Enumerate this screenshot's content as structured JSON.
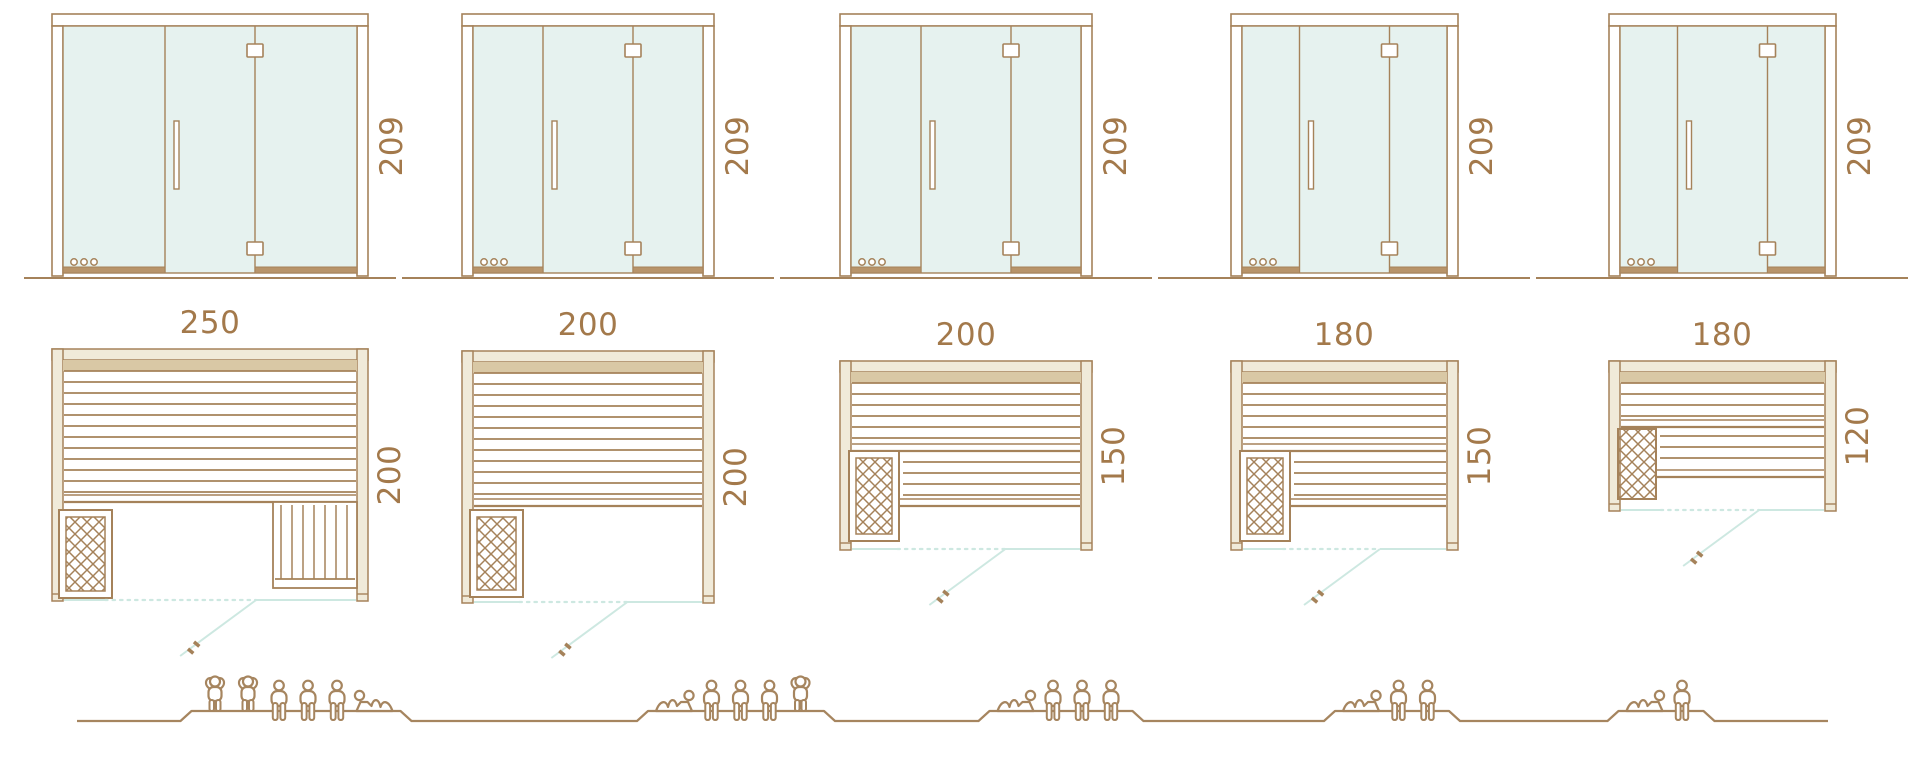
{
  "diagram_title": "sauna-size-comparison",
  "colors": {
    "outline": "#A5825A",
    "label_text": "#A3794B",
    "glass": "#E6F2EF",
    "wall": "#F0EAD9",
    "slat_top": "#D9C8A5",
    "threshold": "#B8946A",
    "swing_line": "#CDE8E1",
    "figure": "#A6855F",
    "background": "#FFFFFF"
  },
  "door": {
    "height_label": "209",
    "features": "glass front with center hinged door, handle, two hinges, three vent holes bottom-left"
  },
  "units": [
    {
      "name": "sauna-250x200",
      "width_label": "250",
      "depth_label": "200",
      "door_height_label": "209",
      "width_cm": 250,
      "depth_cm": 200,
      "plan": "rear bench full width, right side bench, heater front-left, glass front with open door swing",
      "capacity": {
        "standing": 2,
        "sitting": 3,
        "lying": 1
      },
      "figures": [
        "standing",
        "standing",
        "sitting",
        "sitting",
        "sitting",
        "lying"
      ]
    },
    {
      "name": "sauna-200x200",
      "width_label": "200",
      "depth_label": "200",
      "door_height_label": "209",
      "width_cm": 200,
      "depth_cm": 200,
      "plan": "rear bench full width, heater front-left, glass front with open door swing",
      "capacity": {
        "standing": 1,
        "sitting": 3,
        "lying": 1
      },
      "figures": [
        "lying",
        "sitting",
        "sitting",
        "sitting",
        "standing"
      ]
    },
    {
      "name": "sauna-200x150",
      "width_label": "200",
      "depth_label": "150",
      "door_height_label": "209",
      "width_cm": 200,
      "depth_cm": 150,
      "plan": "rear bench full width, lower bench beside heater, heater front-left, glass front with open door swing",
      "capacity": {
        "standing": 0,
        "sitting": 3,
        "lying": 1
      },
      "figures": [
        "lying",
        "sitting",
        "sitting",
        "sitting"
      ]
    },
    {
      "name": "sauna-180x150",
      "width_label": "180",
      "depth_label": "150",
      "door_height_label": "209",
      "width_cm": 180,
      "depth_cm": 150,
      "plan": "rear bench full width, lower bench beside heater, heater front-left, glass front with open door swing",
      "capacity": {
        "standing": 0,
        "sitting": 2,
        "lying": 1
      },
      "figures": [
        "lying",
        "sitting",
        "sitting"
      ]
    },
    {
      "name": "sauna-180x120",
      "width_label": "180",
      "depth_label": "120",
      "door_height_label": "209",
      "width_cm": 180,
      "depth_cm": 120,
      "plan": "rear bench full width, lower bench beside heater, heater front-left, glass front with open door swing",
      "capacity": {
        "standing": 0,
        "sitting": 1,
        "lying": 1
      },
      "figures": [
        "lying",
        "sitting"
      ]
    }
  ]
}
